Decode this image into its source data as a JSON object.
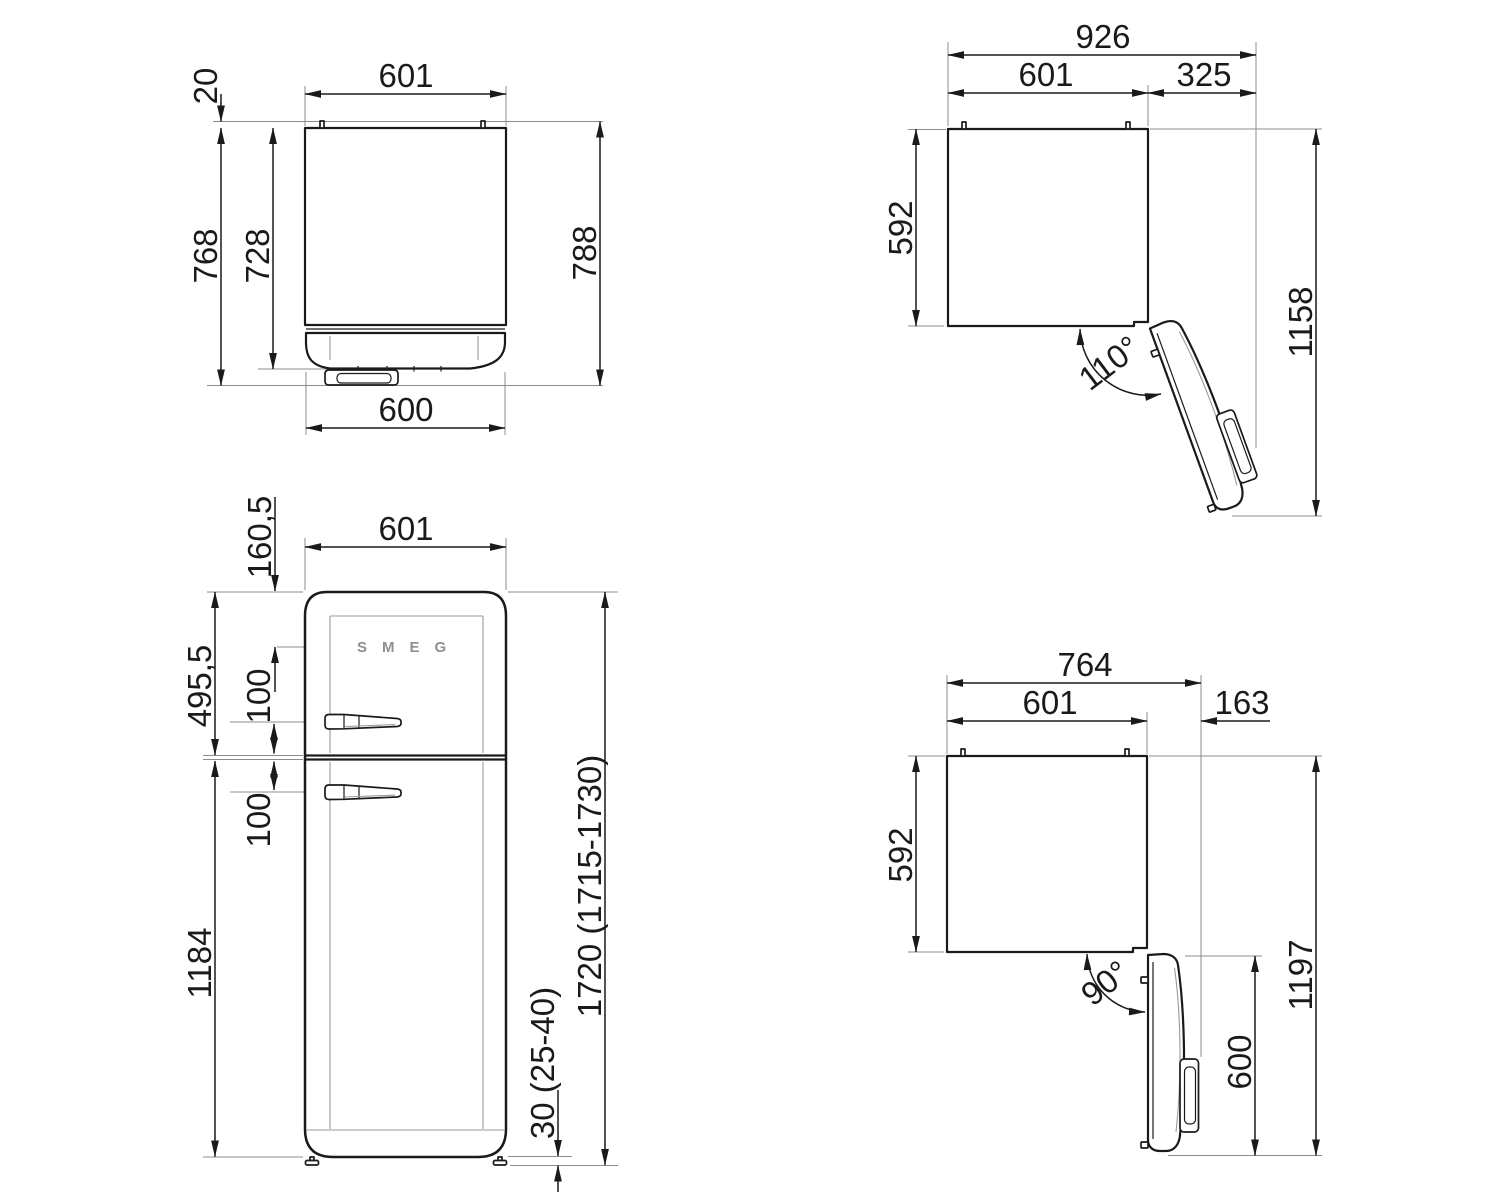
{
  "palette": {
    "background": "#ffffff",
    "ink": "#1a1a1a",
    "reference_lines": "#8c8c8c",
    "logo": "#8f8f8f"
  },
  "views": {
    "top_closed": {
      "label": "top-view-door-closed",
      "dims": {
        "hinge_pin_depth": "20",
        "width": "601",
        "depth_with_door": "768",
        "cabinet_depth": "728",
        "overall_depth": "788",
        "door_width": "600"
      }
    },
    "open110": {
      "label": "top-view-door-open-110",
      "dims": {
        "overall_width": "926",
        "width": "601",
        "door_swing_extension": "325",
        "cabinet_depth": "592",
        "overall_depth": "1158",
        "angle": "110°"
      }
    },
    "front": {
      "label": "front-view",
      "logo": "SMEG",
      "dims": {
        "top_to_logo": "160,5",
        "width": "601",
        "freezer_door_height": "495,5",
        "upper_handle_offset": "100",
        "lower_handle_offset": "100",
        "fridge_door_height": "1184",
        "overall_height": "1720 (1715-1730)",
        "feet_height": "30 (25-40)"
      }
    },
    "open90": {
      "label": "top-view-door-open-90",
      "dims": {
        "overall_width": "764",
        "width": "601",
        "door_swing_extension": "163",
        "cabinet_depth": "592",
        "overall_depth": "1197",
        "door_width": "600",
        "angle": "90°"
      }
    }
  }
}
